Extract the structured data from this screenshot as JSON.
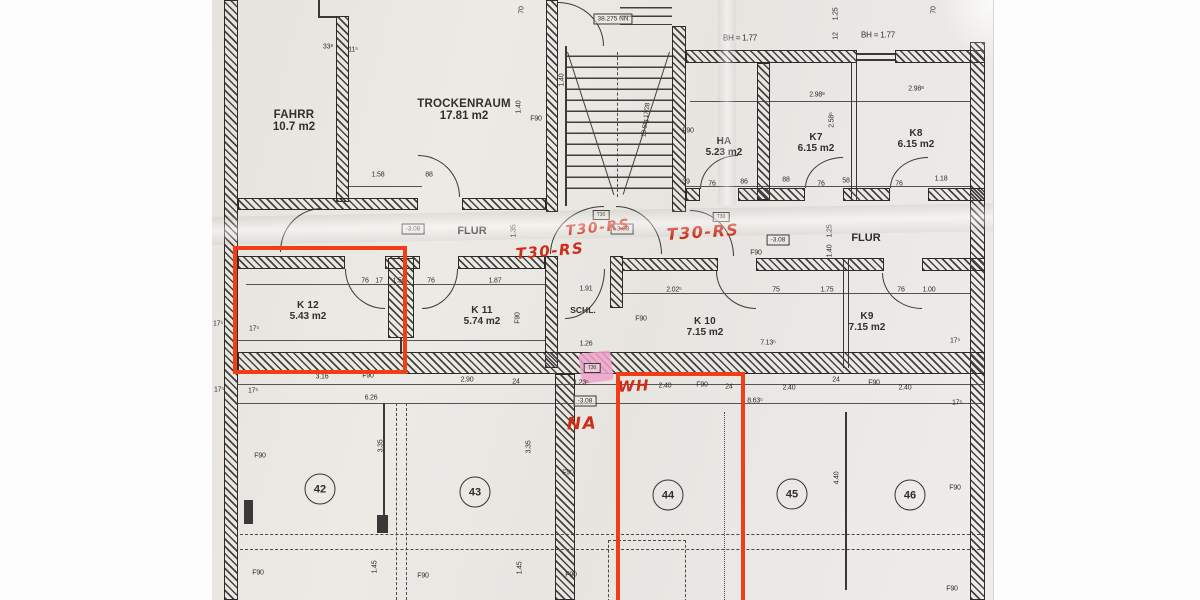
{
  "colors": {
    "red_pen": "#cf2c18",
    "red_box": "#f23d16",
    "pink_highlight": "#efa2cb",
    "ink": "#2e2d2b",
    "paper": "#e9e6e1"
  },
  "rooms": [
    {
      "n": "FAHRR",
      "a": "10.7 m2",
      "x": 294,
      "y": 121,
      "s": 11.5
    },
    {
      "n": "TROCKENRAUM",
      "a": "17.81 m2",
      "x": 464,
      "y": 110,
      "s": 11.5
    },
    {
      "n": "HA",
      "a": "5.23 m2",
      "x": 724,
      "y": 147,
      "s": 10
    },
    {
      "n": "K7",
      "a": "6.15 m2",
      "x": 816,
      "y": 143,
      "s": 10
    },
    {
      "n": "K8",
      "a": "6.15 m2",
      "x": 916,
      "y": 139,
      "s": 10
    },
    {
      "n": "K 12",
      "a": "5.43 m2",
      "x": 308,
      "y": 311,
      "s": 10
    },
    {
      "n": "K 11",
      "a": "5.74 m2",
      "x": 482,
      "y": 316,
      "s": 10
    },
    {
      "n": "K 10",
      "a": "7.15 m2",
      "x": 705,
      "y": 327,
      "s": 10
    },
    {
      "n": "K9",
      "a": "7.15 m2",
      "x": 867,
      "y": 322,
      "s": 10
    }
  ],
  "corridors": [
    {
      "t": "FLUR",
      "x": 472,
      "y": 231,
      "s": 11
    },
    {
      "t": "FLUR",
      "x": 866,
      "y": 238,
      "s": 11
    },
    {
      "t": "SCHL.",
      "x": 583,
      "y": 310,
      "s": 8.5
    }
  ],
  "zones": [
    {
      "t": "42",
      "x": 320,
      "y": 489
    },
    {
      "t": "43",
      "x": 475,
      "y": 492
    },
    {
      "t": "44",
      "x": 668,
      "y": 495
    },
    {
      "t": "45",
      "x": 792,
      "y": 494
    },
    {
      "t": "46",
      "x": 910,
      "y": 495
    }
  ],
  "red_notes": [
    {
      "t": "T30-RS",
      "x": 550,
      "y": 251,
      "r": -5,
      "s": 15
    },
    {
      "t": "T30-RS",
      "x": 598,
      "y": 228,
      "r": -6,
      "s": 14
    },
    {
      "t": "T30-RS",
      "x": 703,
      "y": 232,
      "r": -4,
      "s": 16
    },
    {
      "t": "WH",
      "x": 634,
      "y": 386,
      "r": -3,
      "s": 15
    },
    {
      "t": "NA",
      "x": 582,
      "y": 424,
      "r": -2,
      "s": 17
    }
  ],
  "level_boxes": [
    {
      "t": "38.275 NN",
      "x": 613,
      "y": 19,
      "s": 6.5
    },
    {
      "t": "-3.08",
      "x": 413,
      "y": 229,
      "s": 6.5
    },
    {
      "t": "-3.08",
      "x": 622,
      "y": 229,
      "s": 6.5
    },
    {
      "t": "-3.08",
      "x": 778,
      "y": 240,
      "s": 6.5
    },
    {
      "t": "-3.08",
      "x": 585,
      "y": 401,
      "s": 6.5
    },
    {
      "t": "T30",
      "x": 601,
      "y": 215,
      "s": 5
    },
    {
      "t": "T30",
      "x": 721,
      "y": 217,
      "s": 5
    },
    {
      "t": "T30",
      "x": 592,
      "y": 368,
      "s": 5
    }
  ],
  "dims": [
    {
      "t": "33⁸",
      "x": 328,
      "y": 47
    },
    {
      "t": "11⁵",
      "x": 353,
      "y": 50
    },
    {
      "t": "70",
      "x": 522,
      "y": 10,
      "r": -90
    },
    {
      "t": "70",
      "x": 934,
      "y": 10,
      "r": -90
    },
    {
      "t": "1.25",
      "x": 836,
      "y": 14,
      "r": -90
    },
    {
      "t": "12",
      "x": 836,
      "y": 36,
      "r": -90
    },
    {
      "t": "BH = 1.77",
      "x": 740,
      "y": 38,
      "s": 8
    },
    {
      "t": "BH = 1.77",
      "x": 878,
      "y": 35,
      "s": 8
    },
    {
      "t": "1.40",
      "x": 562,
      "y": 80,
      "r": -90
    },
    {
      "t": "2.98⁸",
      "x": 817,
      "y": 95
    },
    {
      "t": "2.98⁸",
      "x": 916,
      "y": 89
    },
    {
      "t": "1.40",
      "x": 519,
      "y": 107,
      "r": -90
    },
    {
      "t": "2.58⁵",
      "x": 832,
      "y": 120,
      "r": -90
    },
    {
      "t": "F90",
      "x": 536,
      "y": 119
    },
    {
      "t": "F90",
      "x": 688,
      "y": 131
    },
    {
      "t": "18 Stg 17/28",
      "x": 646,
      "y": 120,
      "r": -83,
      "s": 6.5
    },
    {
      "t": "1.58",
      "x": 378,
      "y": 175
    },
    {
      "t": "88",
      "x": 429,
      "y": 175
    },
    {
      "t": "39",
      "x": 686,
      "y": 182
    },
    {
      "t": "76",
      "x": 712,
      "y": 184
    },
    {
      "t": "86",
      "x": 744,
      "y": 182
    },
    {
      "t": "88",
      "x": 786,
      "y": 180
    },
    {
      "t": "76",
      "x": 821,
      "y": 184
    },
    {
      "t": "58",
      "x": 846,
      "y": 181
    },
    {
      "t": "76",
      "x": 899,
      "y": 184
    },
    {
      "t": "1.18",
      "x": 941,
      "y": 179
    },
    {
      "t": "1.35",
      "x": 514,
      "y": 231,
      "r": -90
    },
    {
      "t": "1.25",
      "x": 830,
      "y": 231,
      "r": -90
    },
    {
      "t": "1.40",
      "x": 830,
      "y": 251,
      "r": -90
    },
    {
      "t": "F90",
      "x": 756,
      "y": 253
    },
    {
      "t": "76",
      "x": 365,
      "y": 281
    },
    {
      "t": "17",
      "x": 379,
      "y": 281
    },
    {
      "t": "1.50",
      "x": 399,
      "y": 281
    },
    {
      "t": "76",
      "x": 431,
      "y": 281
    },
    {
      "t": "1.87",
      "x": 495,
      "y": 281
    },
    {
      "t": "1.91",
      "x": 586,
      "y": 289
    },
    {
      "t": "2.02⁵",
      "x": 674,
      "y": 290
    },
    {
      "t": "75",
      "x": 776,
      "y": 290
    },
    {
      "t": "1.75",
      "x": 827,
      "y": 290
    },
    {
      "t": "76",
      "x": 901,
      "y": 290
    },
    {
      "t": "1.00",
      "x": 929,
      "y": 290
    },
    {
      "t": "17⁵",
      "x": 218,
      "y": 324
    },
    {
      "t": "17⁵",
      "x": 254,
      "y": 329
    },
    {
      "t": "F90",
      "x": 518,
      "y": 318,
      "r": -90
    },
    {
      "t": "F90",
      "x": 641,
      "y": 319
    },
    {
      "t": "1.26",
      "x": 586,
      "y": 344
    },
    {
      "t": "7.13⁵",
      "x": 768,
      "y": 343
    },
    {
      "t": "17⁵",
      "x": 955,
      "y": 341
    },
    {
      "t": "3.16",
      "x": 322,
      "y": 377
    },
    {
      "t": "F90",
      "x": 368,
      "y": 376
    },
    {
      "t": "2.90",
      "x": 467,
      "y": 380
    },
    {
      "t": "24",
      "x": 516,
      "y": 382
    },
    {
      "t": "1.23⁵",
      "x": 581,
      "y": 383
    },
    {
      "t": "2.40",
      "x": 665,
      "y": 386
    },
    {
      "t": "F90",
      "x": 702,
      "y": 385
    },
    {
      "t": "24",
      "x": 729,
      "y": 387
    },
    {
      "t": "2.40",
      "x": 789,
      "y": 388
    },
    {
      "t": "24",
      "x": 836,
      "y": 380
    },
    {
      "t": "F90",
      "x": 874,
      "y": 383
    },
    {
      "t": "2.40",
      "x": 905,
      "y": 388
    },
    {
      "t": "17⁵",
      "x": 219,
      "y": 390
    },
    {
      "t": "17⁵",
      "x": 253,
      "y": 391
    },
    {
      "t": "6.26",
      "x": 371,
      "y": 398
    },
    {
      "t": "8.63⁵",
      "x": 755,
      "y": 401
    },
    {
      "t": "17⁵",
      "x": 957,
      "y": 403
    },
    {
      "t": "3.35",
      "x": 381,
      "y": 446,
      "r": -90
    },
    {
      "t": "3.35",
      "x": 529,
      "y": 447,
      "r": -90
    },
    {
      "t": "F90",
      "x": 260,
      "y": 456
    },
    {
      "t": "F90",
      "x": 568,
      "y": 473
    },
    {
      "t": "4.40",
      "x": 837,
      "y": 478,
      "r": -90
    },
    {
      "t": "F90",
      "x": 955,
      "y": 488
    },
    {
      "t": "1.45",
      "x": 375,
      "y": 567,
      "r": -90
    },
    {
      "t": "1.45",
      "x": 520,
      "y": 568,
      "r": -90
    },
    {
      "t": "F90",
      "x": 258,
      "y": 573
    },
    {
      "t": "F90",
      "x": 423,
      "y": 576
    },
    {
      "t": "F90",
      "x": 571,
      "y": 575
    },
    {
      "t": "F90",
      "x": 952,
      "y": 589
    }
  ]
}
